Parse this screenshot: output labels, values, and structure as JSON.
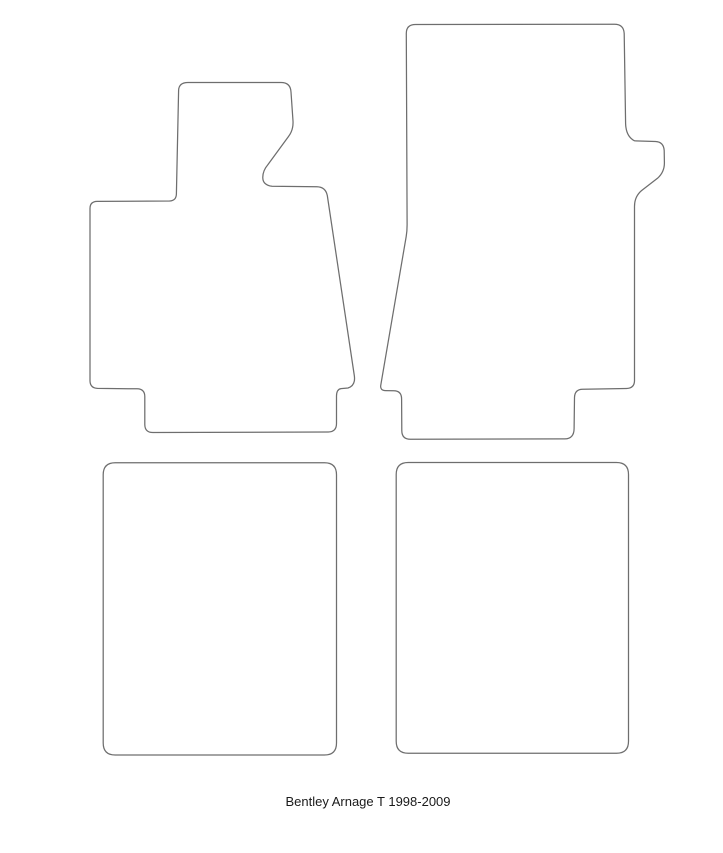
{
  "caption": {
    "text": "Bentley Arnage T 1998-2009"
  },
  "colors": {
    "outline": "#6e6e6e",
    "background": "#ffffff",
    "caption": "#1a1a1a"
  },
  "shapes": {
    "front_left": {
      "label": "front left floor mat outline",
      "path": "M 188,82.5 L 281,82.5 Q 290.5,82.5 291,92 L 293,121 Q 293.5,130 288.5,136.5 L 268,164.5 Q 262.5,171 262.8,178 Q 263,185 272,186.3 L 317,186.8 Q 325.5,187 327.3,195.5 L 354.3,375.5 Q 355.8,385.5 348,388 L 341,388.6 Q 336.6,389.3 336.5,396 L 336.5,423.5 Q 336.5,431.8 328.3,432 L 153,432.5 Q 144.9,432.6 144.8,424.5 L 144.8,396.5 Q 144.7,389 137.2,388.8 L 97.5,388.4 Q 90,388 90,380.5 L 90,208.5 Q 90,201.6 97,201.4 L 169.5,201 Q 176.2,200.8 176.4,194 L 178.6,90.5 Q 178.8,82.5 188,82.5 Z"
    },
    "front_right": {
      "label": "front right floor mat outline",
      "path": "M 415.5,24.5 L 614.5,24.2 Q 623.7,24.2 624.2,33.5 L 625.6,123.5 Q 626,136.5 634.5,140.8 L 655.5,141.5 Q 663.6,141.9 664.2,150.5 L 664.4,162.5 Q 664.6,172 657.5,178.3 L 641.5,190.6 Q 634.5,196.5 634.5,206.5 L 634.5,380.5 Q 634.5,388.2 626.5,388.5 L 582.6,389.3 Q 574.7,389.5 574.5,397.5 L 574.1,428.5 Q 574,438.8 564.8,438.9 L 410.5,439.3 Q 401.9,439.4 401.8,430.8 L 401.6,399 Q 401.6,390.9 393.8,390.8 L 385.5,390.6 Q 379.8,390.4 380.8,385 L 406.2,236.5 Q 407.2,230.5 407.1,223.5 L 406.3,33.5 Q 406.3,24.5 415.5,24.5 Z"
    },
    "rear_left": {
      "label": "rear left floor mat outline",
      "path": "M 115.2,462.8 L 324.5,462.8 Q 336.5,462.8 336.5,474.8 L 336.5,743 Q 336.5,755 324.5,755 L 115.2,755 Q 103.2,755 103.2,743 L 103.2,474.8 Q 103.2,462.8 115.2,462.8 Z"
    },
    "rear_right": {
      "label": "rear right floor mat outline",
      "path": "M 408.2,462.5 L 616.5,462.5 Q 628.5,462.5 628.5,474.5 L 628.5,741.3 Q 628.5,753.3 616.5,753.3 L 408.2,753.3 Q 396.2,753.3 396.2,741.3 L 396.2,474.5 Q 396.2,462.5 408.2,462.5 Z"
    }
  }
}
